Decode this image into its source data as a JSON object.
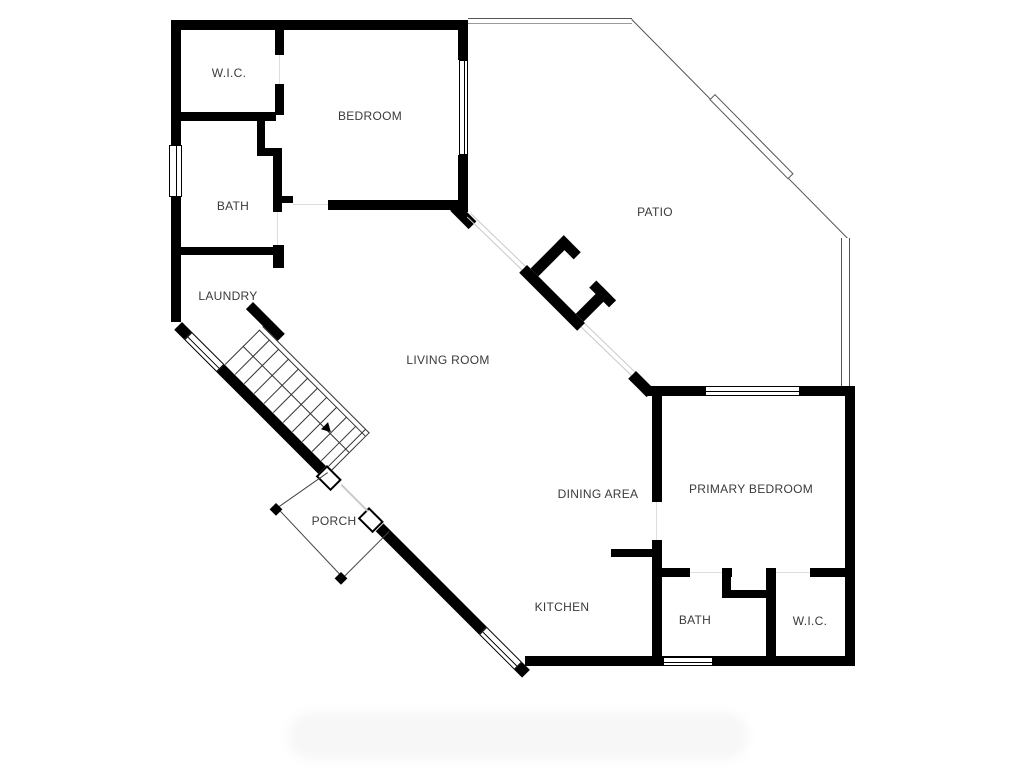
{
  "plan": {
    "type": "floor-plan",
    "colors": {
      "wall": "#000000",
      "background": "#ffffff",
      "thin_line": "#555555",
      "glass_line": "#c9c9c9",
      "label_text": "#3a3a3a"
    },
    "rooms": [
      {
        "id": "wic-upper",
        "label": "W.I.C."
      },
      {
        "id": "bedroom",
        "label": "BEDROOM"
      },
      {
        "id": "bath-upper",
        "label": "BATH"
      },
      {
        "id": "laundry",
        "label": "LAUNDRY"
      },
      {
        "id": "patio",
        "label": "PATIO"
      },
      {
        "id": "living-room",
        "label": "LIVING ROOM"
      },
      {
        "id": "porch",
        "label": "PORCH"
      },
      {
        "id": "dining-area",
        "label": "DINING AREA"
      },
      {
        "id": "primary-bedroom",
        "label": "PRIMARY BEDROOM"
      },
      {
        "id": "kitchen",
        "label": "KITCHEN"
      },
      {
        "id": "bath-lower",
        "label": "BATH"
      },
      {
        "id": "wic-lower",
        "label": "W.I.C."
      }
    ],
    "stairs": {
      "arrow_direction": "down-right",
      "treads": 11
    }
  }
}
